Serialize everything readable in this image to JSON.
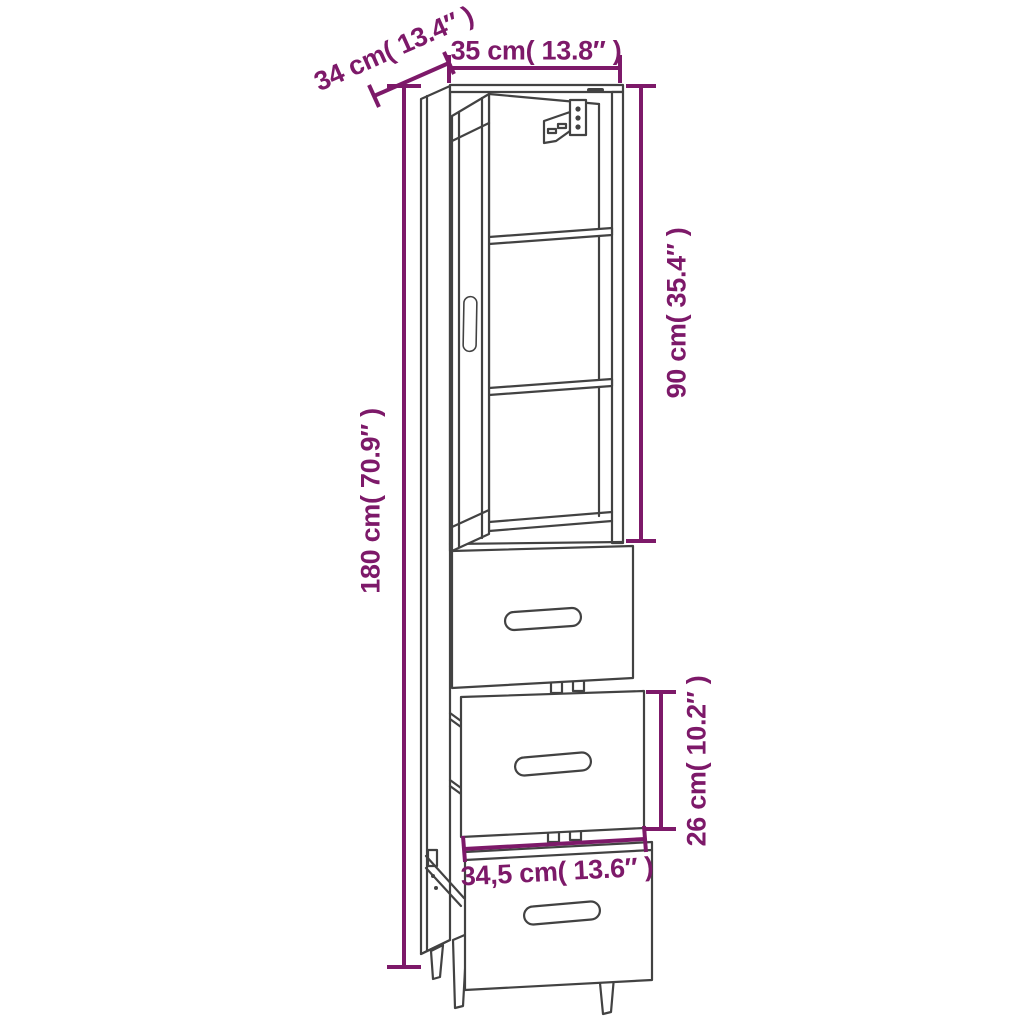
{
  "figure": {
    "type": "furniture dimension diagram",
    "subject": "Tall highboard cabinet with open glass door, two shelves, wall-mount bracket and three drawers",
    "background_color": "#ffffff",
    "line_color": "#424242",
    "dimension_color": "#7D1969"
  },
  "dimensions": {
    "depth": "34 cm( 13.4″ )",
    "width": "35 cm( 13.8″ )",
    "upper_cabinet_height": "90 cm( 35.4″ )",
    "total_height": "180 cm( 70.9″ )",
    "drawer_front_height": "26 cm( 10.2″ )",
    "drawer_front_width": "34,5 cm( 13.6″ )"
  }
}
